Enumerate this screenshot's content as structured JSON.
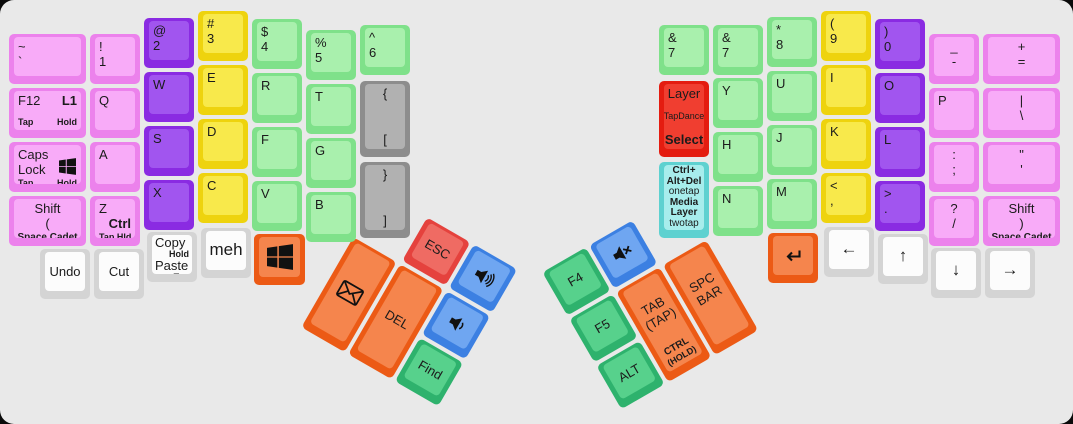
{
  "board": {
    "background": "#e9e9e9",
    "outside": "#0a0a0a"
  },
  "palette": {
    "pink": {
      "b": "#ec82ec",
      "s": "#f8abf8"
    },
    "purple": {
      "b": "#8a2be2",
      "s": "#a155ef"
    },
    "yellow": {
      "b": "#eed30e",
      "s": "#f8e94b"
    },
    "green": {
      "b": "#7fe18a",
      "s": "#a9f0ad"
    },
    "mint": {
      "b": "#2eb26d",
      "s": "#57d18c"
    },
    "gray": {
      "b": "#8d8d8d",
      "s": "#b1b1b1"
    },
    "white": {
      "b": "#d4d4d4",
      "s": "#fcfcfc"
    },
    "red": {
      "b": "#e5423d",
      "s": "#ef6b63"
    },
    "red2": {
      "b": "#e41c10",
      "s": "#f03e30"
    },
    "blue": {
      "b": "#3c80e2",
      "s": "#6fa6f1"
    },
    "orange": {
      "b": "#ec5a15",
      "s": "#f5854d"
    },
    "cyan": {
      "b": "#5ed1d0",
      "s": "#a7edec"
    }
  },
  "keys": [
    {
      "name": "key-tilde",
      "color": "pink",
      "x": 8,
      "y": 33,
      "w": 81,
      "lines": [
        {
          "l": "~"
        },
        {
          "l": "`"
        }
      ]
    },
    {
      "name": "key-exclamation-1",
      "color": "pink",
      "x": 89,
      "y": 33,
      "lines": [
        {
          "l": "!"
        },
        {
          "l": "1"
        }
      ]
    },
    {
      "name": "key-at-2",
      "color": "purple",
      "x": 143,
      "y": 17,
      "lines": [
        {
          "l": "@"
        },
        {
          "l": "2"
        }
      ]
    },
    {
      "name": "key-hash-3",
      "color": "yellow",
      "x": 197,
      "y": 10,
      "lines": [
        {
          "l": "#"
        },
        {
          "l": "3"
        }
      ]
    },
    {
      "name": "key-dollar-4",
      "color": "green",
      "x": 251,
      "y": 18,
      "lines": [
        {
          "l": "$"
        },
        {
          "l": "4"
        }
      ]
    },
    {
      "name": "key-percent-5",
      "color": "green",
      "x": 305,
      "y": 29,
      "lines": [
        {
          "l": "%"
        },
        {
          "l": "5"
        }
      ]
    },
    {
      "name": "key-caret-6",
      "color": "green",
      "x": 359,
      "y": 24,
      "lines": [
        {
          "l": "^"
        },
        {
          "l": "6"
        }
      ]
    },
    {
      "name": "key-f12-l1",
      "color": "pink",
      "x": 8,
      "y": 87,
      "w": 81,
      "lines": [
        {
          "l": "F12",
          "r": "L1",
          "rb": 1
        },
        {
          "l": "Tap",
          "r": "Hold",
          "b": 1,
          "s": "xs",
          "push": 1
        }
      ]
    },
    {
      "name": "key-q",
      "color": "pink",
      "x": 89,
      "y": 87,
      "lines": [
        {
          "l": "Q"
        }
      ]
    },
    {
      "name": "key-w",
      "color": "purple",
      "x": 143,
      "y": 71,
      "lines": [
        {
          "l": "W"
        }
      ]
    },
    {
      "name": "key-e",
      "color": "yellow",
      "x": 197,
      "y": 64,
      "lines": [
        {
          "l": "E"
        }
      ]
    },
    {
      "name": "key-r",
      "color": "green",
      "x": 251,
      "y": 72,
      "lines": [
        {
          "l": "R"
        }
      ]
    },
    {
      "name": "key-t",
      "color": "green",
      "x": 305,
      "y": 83,
      "lines": [
        {
          "l": "T"
        }
      ]
    },
    {
      "name": "key-left-brace-bracket",
      "color": "gray",
      "x": 359,
      "y": 80,
      "h": 80,
      "lines": [
        {
          "c": "{"
        },
        {
          "c": "[",
          "push": 1
        }
      ]
    },
    {
      "name": "key-capslock-win",
      "color": "pink",
      "x": 8,
      "y": 141,
      "w": 81,
      "icon2": "windows",
      "lines": [
        {
          "l": "Caps"
        },
        {
          "l": "Lock"
        },
        {
          "l": "Tap",
          "r": "Hold",
          "b": 1,
          "s": "xs",
          "push": 1
        }
      ]
    },
    {
      "name": "key-a",
      "color": "pink",
      "x": 89,
      "y": 141,
      "lines": [
        {
          "l": "A"
        }
      ]
    },
    {
      "name": "key-s",
      "color": "purple",
      "x": 143,
      "y": 125,
      "lines": [
        {
          "l": "S"
        }
      ]
    },
    {
      "name": "key-d",
      "color": "yellow",
      "x": 197,
      "y": 118,
      "lines": [
        {
          "l": "D"
        }
      ]
    },
    {
      "name": "key-f",
      "color": "green",
      "x": 251,
      "y": 126,
      "lines": [
        {
          "l": "F"
        }
      ]
    },
    {
      "name": "key-g",
      "color": "green",
      "x": 305,
      "y": 137,
      "lines": [
        {
          "l": "G"
        }
      ]
    },
    {
      "name": "key-right-brace-bracket",
      "color": "gray",
      "x": 359,
      "y": 161,
      "h": 80,
      "lines": [
        {
          "c": "}"
        },
        {
          "c": "]",
          "push": 1
        }
      ]
    },
    {
      "name": "key-left-shift",
      "color": "pink",
      "x": 8,
      "y": 195,
      "w": 81,
      "lines": [
        {
          "c": "Shift"
        },
        {
          "c": "(",
          "push": 1
        },
        {
          "c": "Space Cadet",
          "b": 1,
          "s": "sm",
          "push": 1
        }
      ]
    },
    {
      "name": "key-z-ctrl",
      "color": "pink",
      "x": 89,
      "y": 195,
      "lines": [
        {
          "l": "Z"
        },
        {
          "r": "Ctrl",
          "b": 1
        },
        {
          "l": "Tap Hld",
          "b": 1,
          "s": "xs",
          "push": 1
        }
      ]
    },
    {
      "name": "key-x",
      "color": "purple",
      "x": 143,
      "y": 179,
      "lines": [
        {
          "l": "X"
        }
      ]
    },
    {
      "name": "key-c",
      "color": "yellow",
      "x": 197,
      "y": 172,
      "lines": [
        {
          "l": "C"
        }
      ]
    },
    {
      "name": "key-v",
      "color": "green",
      "x": 251,
      "y": 180,
      "lines": [
        {
          "l": "V"
        }
      ]
    },
    {
      "name": "key-b",
      "color": "green",
      "x": 305,
      "y": 191,
      "lines": [
        {
          "l": "B"
        }
      ]
    },
    {
      "name": "key-undo",
      "color": "white",
      "x": 39,
      "y": 248,
      "vc": 1,
      "lines": [
        {
          "c": "Undo"
        }
      ]
    },
    {
      "name": "key-cut",
      "color": "white",
      "x": 93,
      "y": 248,
      "vc": 1,
      "lines": [
        {
          "c": "Cut"
        }
      ]
    },
    {
      "name": "key-copy-paste",
      "color": "white",
      "x": 146,
      "y": 231,
      "tight": 1,
      "lines": [
        {
          "l": "Copy"
        },
        {
          "r": "Hold",
          "b": 1,
          "s": "xs"
        },
        {
          "l": "Paste"
        },
        {
          "r": "Tap",
          "b": 1,
          "s": "xs"
        }
      ]
    },
    {
      "name": "key-meh",
      "color": "white",
      "x": 200,
      "y": 227,
      "vc": 1,
      "lines": [
        {
          "c": "meh",
          "s": "lg"
        }
      ]
    },
    {
      "name": "key-win-left",
      "color": "orange",
      "x": 253,
      "y": 233,
      "w": 55,
      "h": 55,
      "vc": 1,
      "lines": [
        {
          "icon": "windows",
          "isz": 26
        }
      ]
    },
    {
      "name": "key-esc",
      "color": "red",
      "cluster": "lt",
      "x": 54,
      "y": 0,
      "vc": 1,
      "lines": [
        {
          "c": "ESC"
        }
      ]
    },
    {
      "name": "key-volume-up",
      "color": "blue",
      "cluster": "lt",
      "x": 108,
      "y": 0,
      "vc": 1,
      "lines": [
        {
          "icon": "vol-up",
          "isz": 24
        }
      ]
    },
    {
      "name": "key-mail",
      "color": "orange",
      "cluster": "lt",
      "x": 0,
      "y": 54,
      "h": 108,
      "vc": 1,
      "lines": [
        {
          "icon": "mail",
          "isz": 28
        }
      ]
    },
    {
      "name": "key-del",
      "color": "orange",
      "cluster": "lt",
      "x": 54,
      "y": 54,
      "h": 108,
      "vc": 1,
      "lines": [
        {
          "c": "DEL"
        }
      ]
    },
    {
      "name": "key-volume-down",
      "color": "blue",
      "cluster": "lt",
      "x": 108,
      "y": 54,
      "vc": 1,
      "lines": [
        {
          "icon": "vol-down",
          "isz": 24
        }
      ]
    },
    {
      "name": "key-find",
      "color": "mint",
      "cluster": "lt",
      "x": 108,
      "y": 108,
      "vc": 1,
      "lines": [
        {
          "c": "Find"
        }
      ]
    },
    {
      "name": "key-amp-7-inner",
      "color": "green",
      "x": 658,
      "y": 24,
      "lines": [
        {
          "l": "&"
        },
        {
          "l": "7"
        }
      ]
    },
    {
      "name": "key-layer-tapdance-select",
      "color": "red2",
      "x": 658,
      "y": 80,
      "h": 80,
      "lines": [
        {
          "c": "Layer"
        },
        {
          "c": "TapDance",
          "s": "xs",
          "push": 1
        },
        {
          "c": "Select",
          "b": 1,
          "push": 1
        }
      ]
    },
    {
      "name": "key-ctrl-alt-del-media-layer",
      "color": "cyan",
      "x": 658,
      "y": 161,
      "h": 80,
      "tight": 1,
      "lines": [
        {
          "c": "Ctrl+",
          "b": 1,
          "s": "sm"
        },
        {
          "c": "Alt+Del",
          "b": 1,
          "s": "sm"
        },
        {
          "c": "onetap",
          "s": "sm"
        },
        {
          "c": "Media",
          "b": 1,
          "s": "sm",
          "push": 1
        },
        {
          "c": "Layer",
          "b": 1,
          "s": "sm"
        },
        {
          "c": "twotap",
          "s": "sm"
        }
      ]
    },
    {
      "name": "key-amp-7",
      "color": "green",
      "x": 712,
      "y": 24,
      "lines": [
        {
          "l": "&"
        },
        {
          "l": "7"
        }
      ]
    },
    {
      "name": "key-y",
      "color": "green",
      "x": 712,
      "y": 77,
      "lines": [
        {
          "l": "Y"
        }
      ]
    },
    {
      "name": "key-h",
      "color": "green",
      "x": 712,
      "y": 131,
      "lines": [
        {
          "l": "H"
        }
      ]
    },
    {
      "name": "key-n",
      "color": "green",
      "x": 712,
      "y": 185,
      "lines": [
        {
          "l": "N"
        }
      ]
    },
    {
      "name": "key-asterisk-8",
      "color": "green",
      "x": 766,
      "y": 16,
      "lines": [
        {
          "l": "*"
        },
        {
          "l": "8"
        }
      ]
    },
    {
      "name": "key-u",
      "color": "green",
      "x": 766,
      "y": 70,
      "lines": [
        {
          "l": "U"
        }
      ]
    },
    {
      "name": "key-j",
      "color": "green",
      "x": 766,
      "y": 124,
      "lines": [
        {
          "l": "J"
        }
      ]
    },
    {
      "name": "key-m",
      "color": "green",
      "x": 766,
      "y": 178,
      "lines": [
        {
          "l": "M"
        }
      ]
    },
    {
      "name": "key-lparen-9",
      "color": "yellow",
      "x": 820,
      "y": 10,
      "lines": [
        {
          "l": "("
        },
        {
          "l": "9"
        }
      ]
    },
    {
      "name": "key-i",
      "color": "yellow",
      "x": 820,
      "y": 64,
      "lines": [
        {
          "l": "I"
        }
      ]
    },
    {
      "name": "key-k",
      "color": "yellow",
      "x": 820,
      "y": 118,
      "lines": [
        {
          "l": "K"
        }
      ]
    },
    {
      "name": "key-less-comma",
      "color": "yellow",
      "x": 820,
      "y": 172,
      "lines": [
        {
          "l": "<"
        },
        {
          "l": ","
        }
      ]
    },
    {
      "name": "key-rparen-0",
      "color": "purple",
      "x": 874,
      "y": 18,
      "lines": [
        {
          "l": ")"
        },
        {
          "l": "0"
        }
      ]
    },
    {
      "name": "key-o",
      "color": "purple",
      "x": 874,
      "y": 72,
      "lines": [
        {
          "l": "O"
        }
      ]
    },
    {
      "name": "key-l",
      "color": "purple",
      "x": 874,
      "y": 126,
      "lines": [
        {
          "l": "L"
        }
      ]
    },
    {
      "name": "key-greater-period",
      "color": "purple",
      "x": 874,
      "y": 180,
      "lines": [
        {
          "l": ">"
        },
        {
          "l": "."
        }
      ]
    },
    {
      "name": "key-underscore-minus",
      "color": "pink",
      "x": 928,
      "y": 33,
      "lines": [
        {
          "c": "_"
        },
        {
          "c": "-"
        }
      ]
    },
    {
      "name": "key-p",
      "color": "pink",
      "x": 928,
      "y": 87,
      "lines": [
        {
          "l": "P"
        }
      ]
    },
    {
      "name": "key-colon-semicolon",
      "color": "pink",
      "x": 928,
      "y": 141,
      "lines": [
        {
          "c": ":"
        },
        {
          "c": ";"
        }
      ]
    },
    {
      "name": "key-question-slash",
      "color": "pink",
      "x": 928,
      "y": 195,
      "lines": [
        {
          "c": "?"
        },
        {
          "c": "/"
        }
      ]
    },
    {
      "name": "key-plus-equals",
      "color": "pink",
      "x": 982,
      "y": 33,
      "w": 81,
      "lines": [
        {
          "c": "+"
        },
        {
          "c": "="
        }
      ]
    },
    {
      "name": "key-pipe-backslash",
      "color": "pink",
      "x": 982,
      "y": 87,
      "w": 81,
      "lines": [
        {
          "c": "|"
        },
        {
          "c": "\\"
        }
      ]
    },
    {
      "name": "key-quote",
      "color": "pink",
      "x": 982,
      "y": 141,
      "w": 81,
      "lines": [
        {
          "c": "\""
        },
        {
          "c": "'"
        }
      ]
    },
    {
      "name": "key-right-shift",
      "color": "pink",
      "x": 982,
      "y": 195,
      "w": 81,
      "lines": [
        {
          "c": "Shift"
        },
        {
          "c": ")",
          "push": 1
        },
        {
          "c": "Space Cadet",
          "b": 1,
          "s": "sm",
          "push": 1
        }
      ]
    },
    {
      "name": "key-enter",
      "color": "orange",
      "x": 767,
      "y": 232,
      "vc": 1,
      "lines": [
        {
          "icon": "enter",
          "isz": 24
        }
      ]
    },
    {
      "name": "key-arrow-left",
      "color": "white",
      "x": 823,
      "y": 226,
      "vc": 1,
      "lines": [
        {
          "c": "←",
          "s": "lg"
        }
      ]
    },
    {
      "name": "key-arrow-up",
      "color": "white",
      "x": 877,
      "y": 233,
      "vc": 1,
      "lines": [
        {
          "c": "↑",
          "s": "lg"
        }
      ]
    },
    {
      "name": "key-arrow-down",
      "color": "white",
      "x": 930,
      "y": 247,
      "vc": 1,
      "lines": [
        {
          "c": "↓",
          "s": "lg"
        }
      ]
    },
    {
      "name": "key-arrow-right",
      "color": "white",
      "x": 984,
      "y": 247,
      "vc": 1,
      "lines": [
        {
          "c": "→",
          "s": "lg"
        }
      ]
    },
    {
      "name": "key-f4",
      "color": "mint",
      "cluster": "rt",
      "x": 0,
      "y": 0,
      "vc": 1,
      "lines": [
        {
          "c": "F4"
        }
      ]
    },
    {
      "name": "key-mute",
      "color": "blue",
      "cluster": "rt",
      "x": 54,
      "y": 0,
      "vc": 1,
      "lines": [
        {
          "icon": "mute",
          "isz": 24
        }
      ]
    },
    {
      "name": "key-f5",
      "color": "mint",
      "cluster": "rt",
      "x": 0,
      "y": 54,
      "vc": 1,
      "lines": [
        {
          "c": "F5"
        }
      ]
    },
    {
      "name": "key-tab-ctrl",
      "color": "orange",
      "cluster": "rt",
      "x": 54,
      "y": 54,
      "h": 108,
      "lines": [
        {
          "c": "TAB",
          "push": 1
        },
        {
          "c": "(TAP)"
        },
        {
          "c": "CTRL",
          "b": 1,
          "s": "sm",
          "push": 1
        },
        {
          "c": "(HOLD)",
          "b": 1,
          "s": "xs"
        }
      ]
    },
    {
      "name": "key-spacebar",
      "color": "orange",
      "cluster": "rt",
      "x": 108,
      "y": 54,
      "h": 108,
      "lines": [
        {
          "c": "SPC",
          "push": 1
        },
        {
          "c": "BAR"
        },
        {
          "c": " ",
          "push": 1
        }
      ]
    },
    {
      "name": "key-alt",
      "color": "mint",
      "cluster": "rt",
      "x": 0,
      "y": 108,
      "vc": 1,
      "lines": [
        {
          "c": "ALT"
        }
      ]
    }
  ]
}
